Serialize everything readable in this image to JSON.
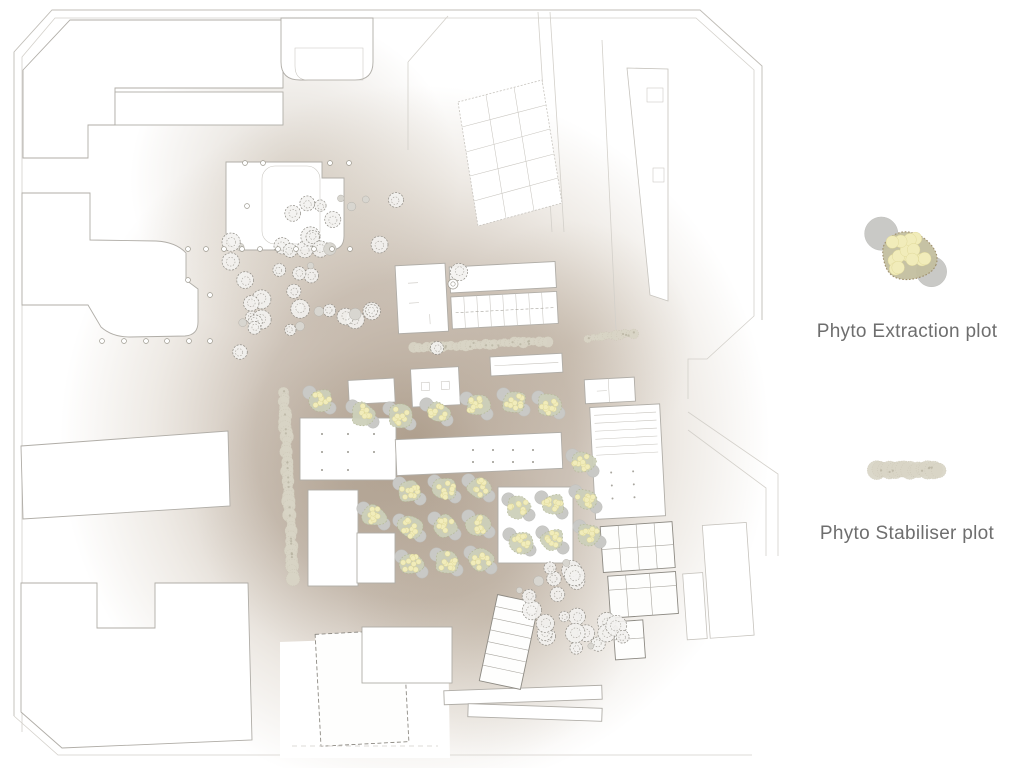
{
  "legend": {
    "items": [
      {
        "id": "phyto-extraction",
        "label": "Phyto Extraction plot",
        "icon": "phyto-extraction-icon"
      },
      {
        "id": "phyto-stabiliser",
        "label": "Phyto Stabiliser plot",
        "icon": "phyto-stabiliser-icon"
      }
    ],
    "text_color": "#6e6e6e"
  },
  "colors": {
    "background": "#ffffff",
    "soil_core": "#a5937f",
    "soil_mid": "#ad9c8a",
    "line": "#b0ada7",
    "line_dark": "#8d8a83",
    "tree_line": "#8f8c85",
    "plot_blob": "#cdd0ba",
    "plot_blob_edge": "#b2b795",
    "plot_dot": "#f1ecba",
    "plot_dot_edge": "#dcd493",
    "plot_stone": "#c9c9c6",
    "stabiliser_fill": "#d9d5c6",
    "stabiliser_edge": "#c2bdab",
    "legend_blob": "#c3bfa0",
    "legend_blob_edge": "#9d8c68"
  },
  "plan": {
    "extraction_plots": [
      [
        320,
        400
      ],
      [
        363,
        414
      ],
      [
        400,
        416
      ],
      [
        437,
        412
      ],
      [
        477,
        406
      ],
      [
        514,
        402
      ],
      [
        549,
        405
      ],
      [
        410,
        491
      ],
      [
        445,
        489
      ],
      [
        479,
        488
      ],
      [
        410,
        528
      ],
      [
        445,
        526
      ],
      [
        479,
        524
      ],
      [
        412,
        564
      ],
      [
        447,
        562
      ],
      [
        481,
        560
      ],
      [
        374,
        516
      ],
      [
        519,
        507
      ],
      [
        552,
        505
      ],
      [
        520,
        542
      ],
      [
        553,
        540
      ],
      [
        583,
        463
      ],
      [
        586,
        499
      ],
      [
        590,
        534
      ]
    ],
    "stabiliser_strips": [
      {
        "x1": 284,
        "y1": 392,
        "x2": 293,
        "y2": 580,
        "w": 11
      },
      {
        "x1": 413,
        "y1": 348,
        "x2": 548,
        "y2": 341,
        "w": 9
      },
      {
        "x1": 588,
        "y1": 338,
        "x2": 634,
        "y2": 333,
        "w": 8
      }
    ],
    "tree_clusters": [
      {
        "cx": 302,
        "cy": 248,
        "rx": 82,
        "ry": 42,
        "angle": -25,
        "count": 27,
        "seed": 11
      },
      {
        "cx": 312,
        "cy": 320,
        "rx": 76,
        "ry": 14,
        "angle": -7,
        "count": 16,
        "seed": 22
      },
      {
        "cx": 570,
        "cy": 614,
        "rx": 36,
        "ry": 52,
        "angle": -32,
        "count": 27,
        "seed": 33
      }
    ],
    "single_trees": [
      [
        240,
        352
      ],
      [
        396,
        200
      ],
      [
        459,
        272
      ],
      [
        437,
        348
      ]
    ],
    "column_dots": [
      [
        188,
        249
      ],
      [
        206,
        249
      ],
      [
        224,
        249
      ],
      [
        242,
        249
      ],
      [
        260,
        249
      ],
      [
        278,
        249
      ],
      [
        296,
        249
      ],
      [
        314,
        249
      ],
      [
        332,
        249
      ],
      [
        350,
        249
      ],
      [
        102,
        341
      ],
      [
        124,
        341
      ],
      [
        146,
        341
      ],
      [
        167,
        341
      ],
      [
        189,
        341
      ],
      [
        210,
        341
      ],
      [
        245,
        163
      ],
      [
        263,
        163
      ],
      [
        330,
        163
      ],
      [
        349,
        163
      ],
      [
        210,
        295
      ],
      [
        247,
        206
      ],
      [
        188,
        280
      ]
    ],
    "spiral_stair": [
      453,
      284
    ]
  }
}
